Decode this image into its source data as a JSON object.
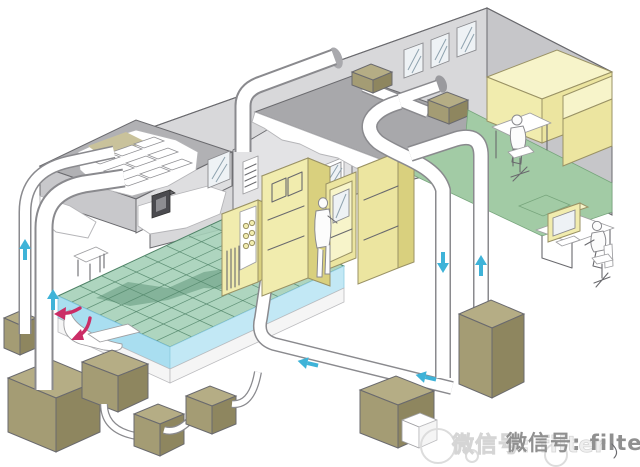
{
  "watermark": {
    "text": "微信号: filter"
  },
  "colors": {
    "white": "#ffffff",
    "line": "#6a6a6e",
    "wall_a": "#d8d8da",
    "wall_b": "#c6c6c9",
    "wall_c": "#e3e3e5",
    "ceiling": "#a8a8ab",
    "block_top": "#b1b1b4",
    "block_left": "#c8c8cb",
    "block_right": "#dedee0",
    "olive": "#c9c29b",
    "floor_green": "#a2cba5",
    "grid_fill": "#a5d0b8",
    "grid_line": "#4e8266",
    "grid_dark": "#528a6c",
    "plenum_blue": "#a9def0",
    "plenum_blue2": "#c2e8f5",
    "yellow": "#f1ecae",
    "yellow_mid": "#ece5a0",
    "yellow_dark": "#d9d07e",
    "yellow_top": "#f7f4ca",
    "khaki_top": "#b5ad85",
    "khaki_front": "#a49c74",
    "khaki_side": "#8e865f",
    "duct_line": "#8a8a8e",
    "arrow_blue": "#3fb3d8",
    "arrow_magenta": "#cb2d66",
    "dark_box": "#4b4b4f",
    "glass": "#eef2f5",
    "glint": "#8fa3af",
    "watermark": "#909090",
    "ghost": "#efefef"
  }
}
